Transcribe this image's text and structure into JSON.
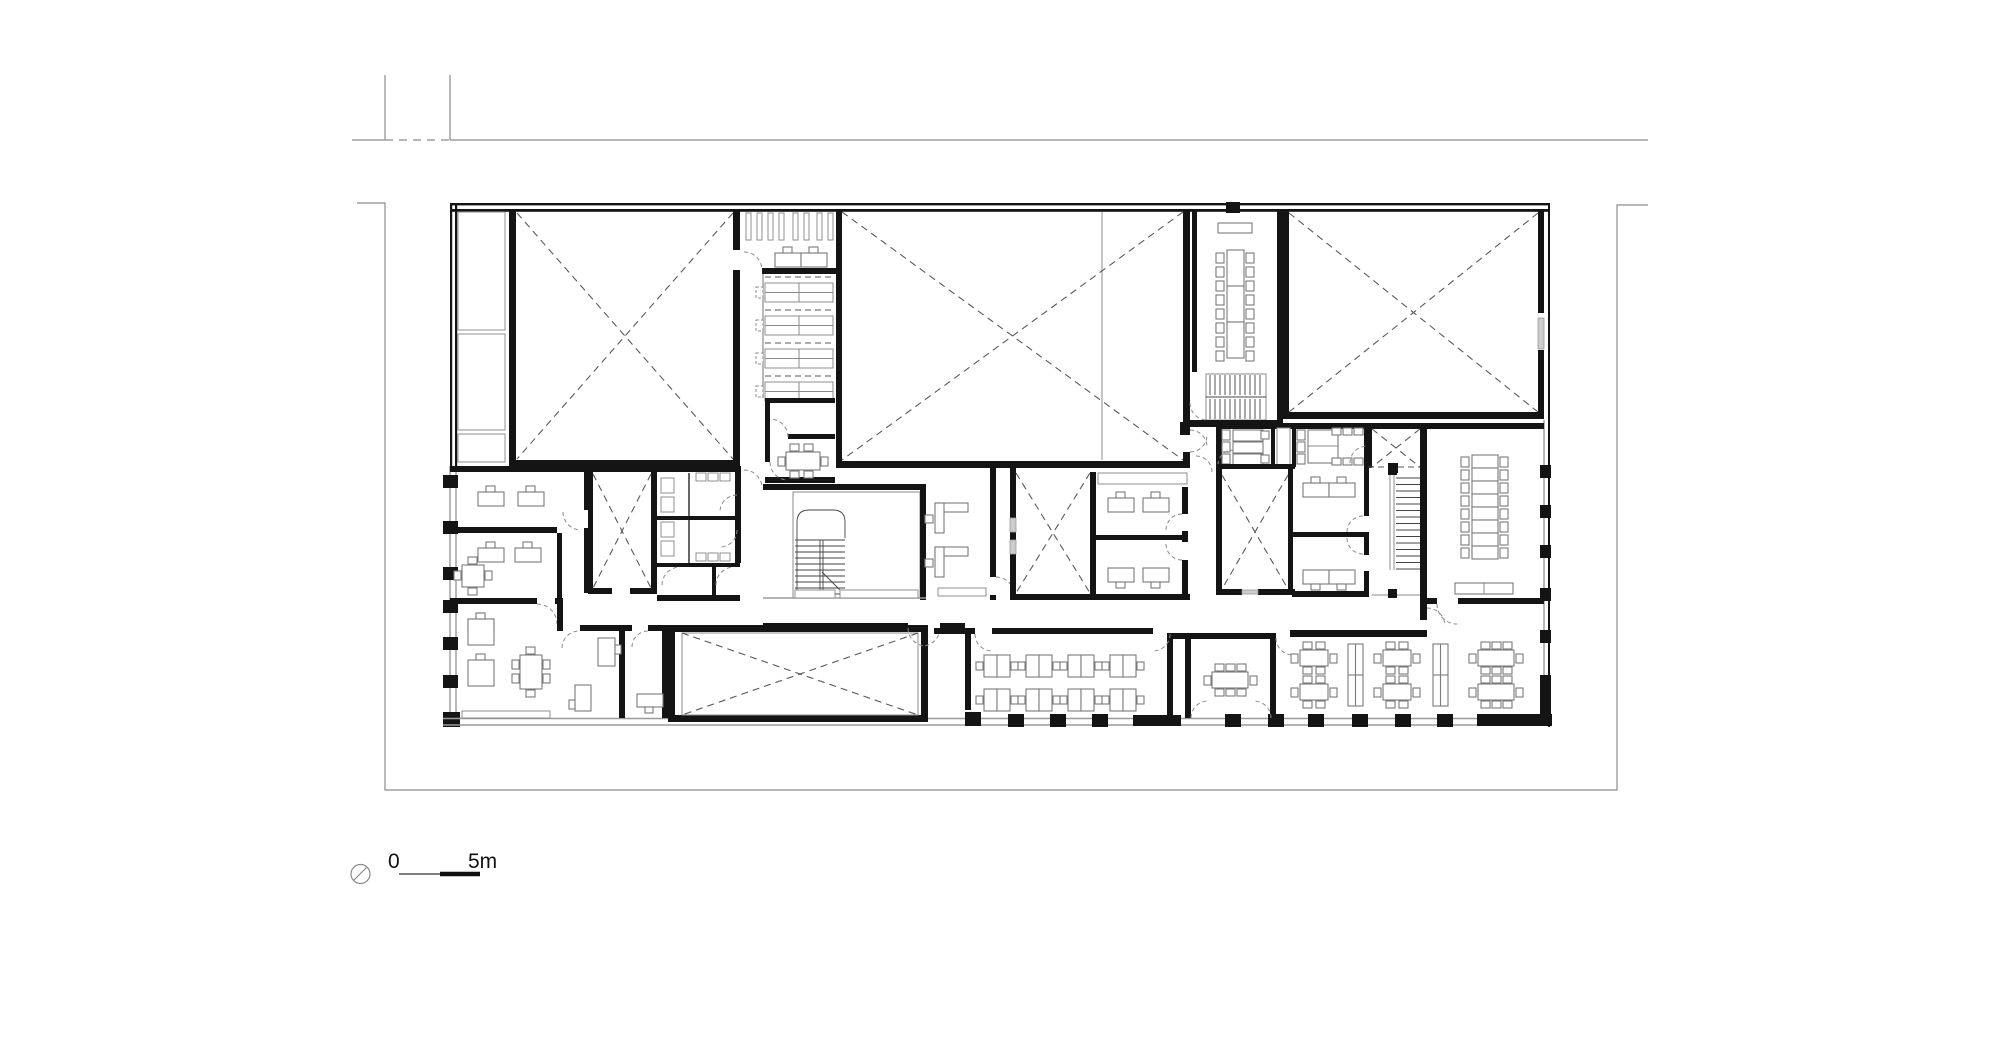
{
  "page": {
    "background": "#ffffff",
    "content": "architectural floor plan drawing, black line work on white"
  },
  "scale_bar": {
    "zero_label": "0",
    "max_label": "5m"
  },
  "symbols": {
    "north_arrow": "small circle with diagonal tick at lower left of scale bar"
  },
  "colors": {
    "wall": "#141414",
    "window_band": "#9a9a9a",
    "glass_fill": "#cccccc",
    "void_dashed": "#5a5a5a",
    "furniture": "#7a7a7a",
    "door_swing": "#8a8a8a",
    "site_boundary": "#8c8c8c",
    "background": "#ffffff"
  },
  "plan_summary": {
    "type": "building floor plan",
    "voids_marked_with_dashed_x": 8,
    "stair_flights": 3,
    "large_halls_top": 3,
    "conference_tables_long": 2,
    "open_office_desk_clusters": 8,
    "reading_tables_bottom_right": 6,
    "bookshelf_rows": 4,
    "wc_cells": 4
  }
}
